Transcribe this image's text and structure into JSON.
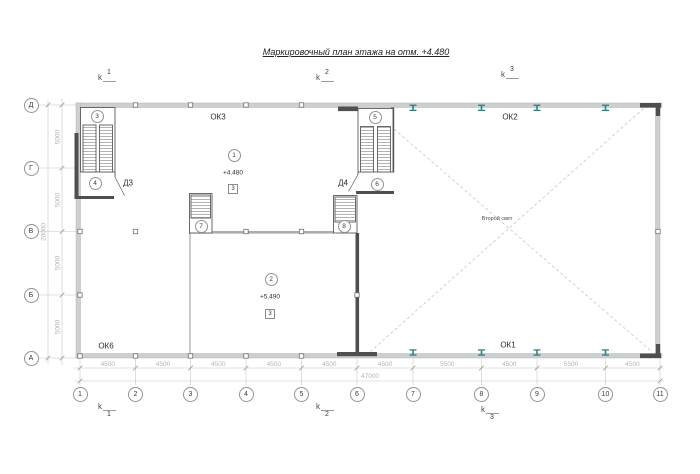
{
  "title": "Маркировочный план этажа на отм. +4.480",
  "grid": {
    "rows": [
      "Д",
      "Г",
      "В",
      "Б",
      "А"
    ],
    "cols": [
      "1",
      "2",
      "3",
      "4",
      "5",
      "6",
      "7",
      "8",
      "9",
      "10",
      "11"
    ]
  },
  "dims": {
    "bottom": [
      "4500",
      "4500",
      "4500",
      "4500",
      "4500",
      "4500",
      "5500",
      "4500",
      "5500",
      "4500"
    ],
    "total_bottom": "47000",
    "left": [
      "5000",
      "5000",
      "5000",
      "5000"
    ],
    "total_left": "20000"
  },
  "sections": {
    "letter": "k",
    "top": [
      "1",
      "2",
      "3"
    ],
    "bottom": [
      "1",
      "2",
      "3"
    ]
  },
  "openings": {
    "ok3": "ОК3",
    "ok2": "ОК2",
    "ok1": "ОК1",
    "ok6": "ОК6"
  },
  "doors": {
    "d3": "Д3",
    "d4": "Д4"
  },
  "rooms": {
    "r1": {
      "num": "1",
      "elev": "+4.480",
      "mark": "3"
    },
    "r2": {
      "num": "2",
      "elev": "+5.490",
      "mark": "3"
    }
  },
  "stairs": {
    "c3": "3",
    "c4": "4",
    "c5": "5",
    "c6": "6",
    "c7": "7",
    "c8": "8"
  },
  "notes": {
    "second_light": "Второй свет"
  },
  "colors": {
    "beam_teal": "#2e7f80",
    "wall_gray": "#ccd0d1",
    "dark_wall": "#4f4f4f",
    "dim_gray": "#b3b3b3"
  }
}
